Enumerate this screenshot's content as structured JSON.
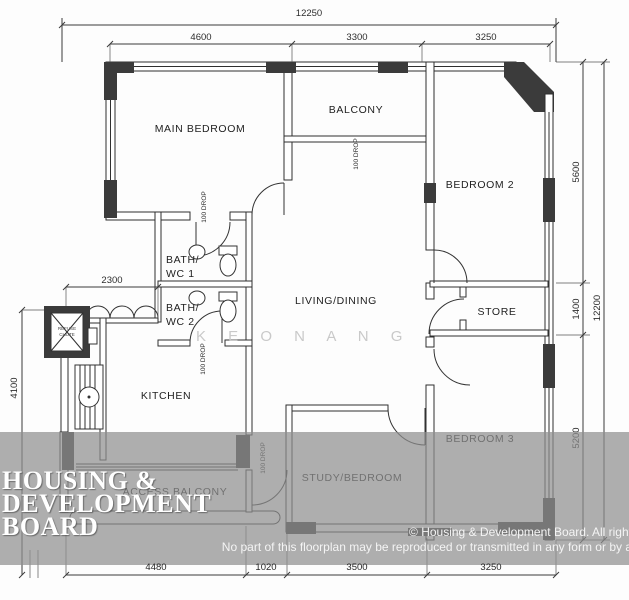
{
  "plan": {
    "rooms": {
      "main_bedroom": "MAIN BEDROOM",
      "balcony": "BALCONY",
      "bedroom2": "BEDROOM 2",
      "bedroom3": "BEDROOM 3",
      "living_dining": "LIVING/DINING",
      "store": "STORE",
      "kitchen": "KITCHEN",
      "study_bedroom": "STUDY/BEDROOM",
      "access_balcony": "ACCESS BALCONY",
      "bath1_line1": "BATH/",
      "bath1_line2": "WC 1",
      "bath2_line1": "BATH/",
      "bath2_line2": "WC 2",
      "refuse_line1": "REFUSE",
      "refuse_line2": "CHUTE"
    },
    "drop_label": "100 DROP",
    "dimensions": {
      "top_overall": "12250",
      "top_seg1": "4600",
      "top_seg2": "3300",
      "top_seg3": "3250",
      "right_seg1": "5600",
      "right_seg2": "1400",
      "right_seg3": "5200",
      "right_overall": "12200",
      "left_vertical": "4100",
      "left_small": "2300",
      "bottom_seg1": "4480",
      "bottom_seg2": "1020",
      "bottom_seg3": "3500",
      "bottom_seg4": "3250"
    }
  },
  "overlay": {
    "branding_line1": "HOUSING &",
    "branding_line2": "DEVELOPMENT",
    "branding_line3": "BOARD",
    "copyright_line1": "© Housing & Development Board. All right",
    "copyright_line2": "No part of this floorplan may be reproduced or transmitted in any form or by a"
  },
  "watermark": {
    "text": "K E O N   A N G"
  },
  "colors": {
    "plan_line": "#2f2f2f",
    "pillar": "#3b3b3b",
    "overlay_band": "#8f8f8f",
    "branding_text": "#ffffff",
    "watermark_text": "#c9c9c9",
    "background": "#fdfdfd"
  }
}
